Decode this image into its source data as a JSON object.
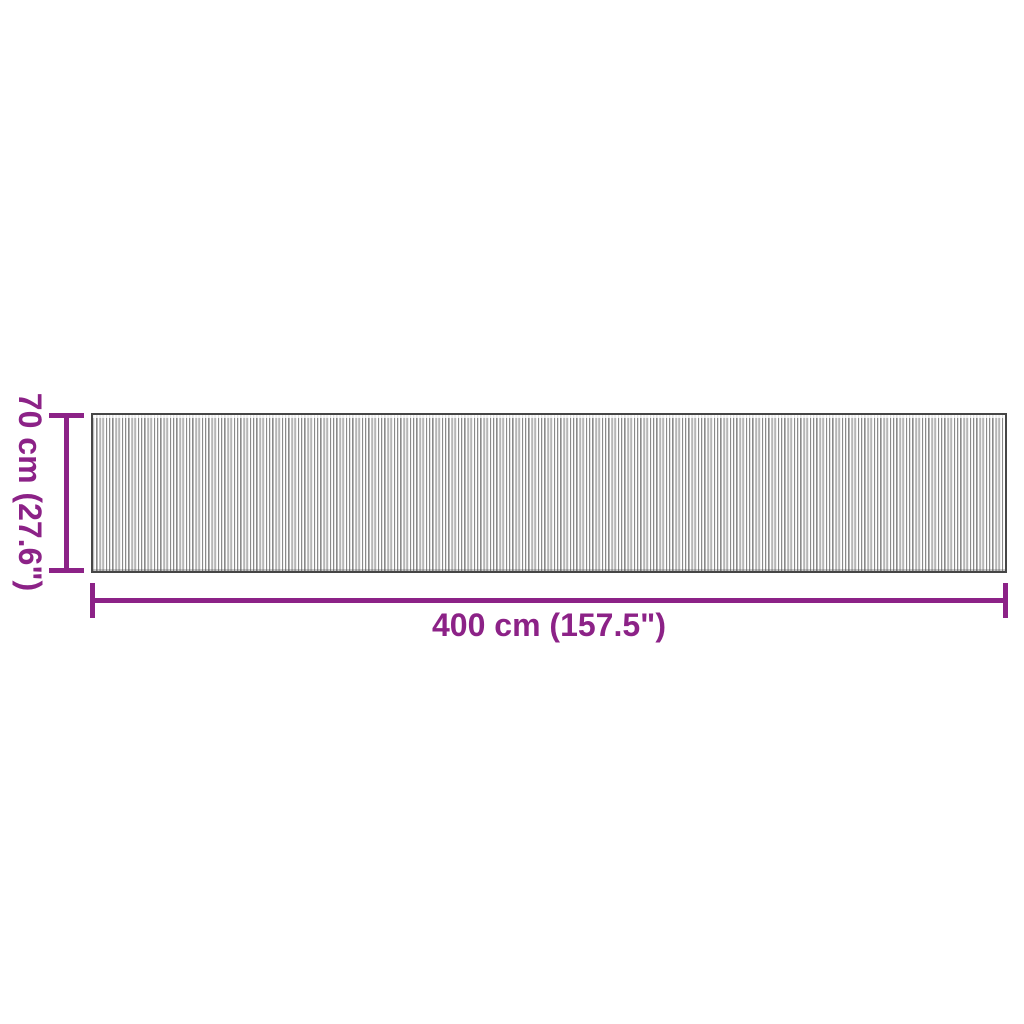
{
  "colors": {
    "dimension_accent": "#8C2287",
    "rug_border": "#464646",
    "rug_stripe_dark": "#8a8a8a",
    "background": "#ffffff"
  },
  "diagram": {
    "kind": "product-dimension-diagram",
    "dimensions": {
      "width": {
        "label": "400 cm (157.5\")"
      },
      "height": {
        "label": "70 cm (27.6\")"
      }
    }
  }
}
